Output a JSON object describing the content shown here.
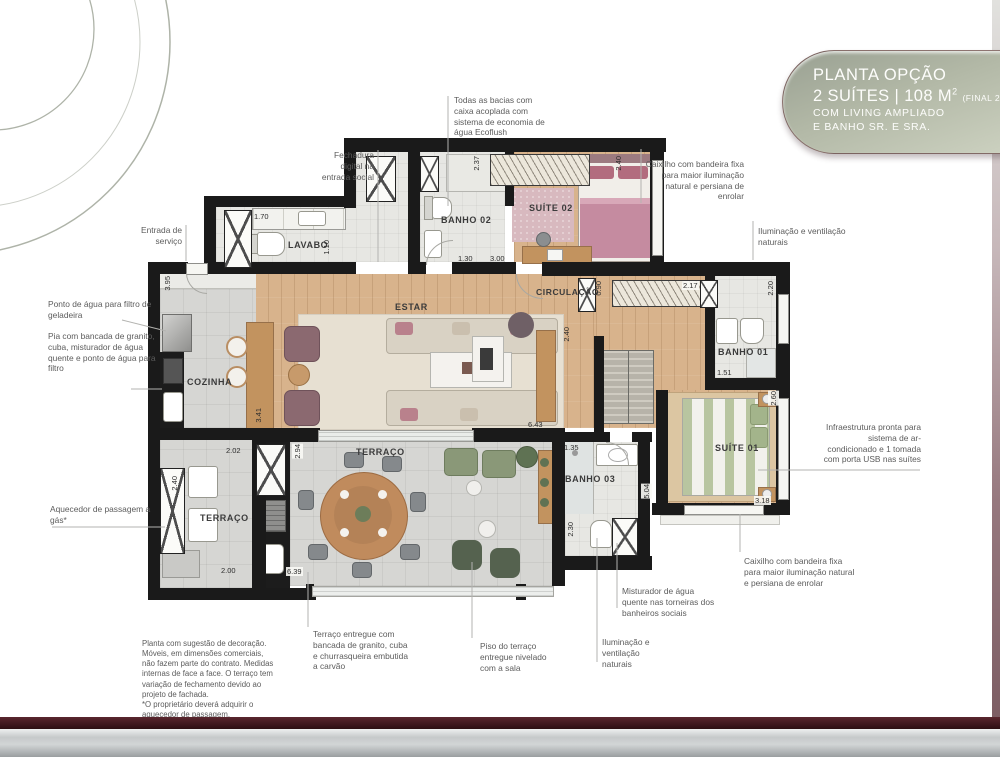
{
  "title_box": {
    "line1": "PLANTA OPÇÃO",
    "line2_main": "2 SUÍTES | 108 M",
    "line2_sup": "2",
    "line2_note": "(FINAL 2)",
    "line3": "COM LIVING AMPLIADO",
    "line4": "E BANHO SR. E SRA."
  },
  "rooms": {
    "lavabo": "LAVABO",
    "banho02": "BANHO 02",
    "suite02": "SUÍTE 02",
    "estar": "ESTAR",
    "circulacao": "CIRCULAÇÃO",
    "banho01": "BANHO 01",
    "suite01": "SUÍTE 01",
    "cozinha": "COZINHA",
    "terraco_servico": "TERRAÇO",
    "terraco": "TERRAÇO",
    "banho03": "BANHO 03"
  },
  "dims": {
    "closet_w": "1.70",
    "lavabo_h": "1.10",
    "servico_h": "3.95",
    "banho02_h": "2.37",
    "banho02_w": "1.30",
    "suite02_w": "3.00",
    "suite02_h": "2.40",
    "circ_w": "0.90",
    "wardrobe_w": "2.17",
    "banho01_h": "2.20",
    "banho01_w": "1.51",
    "circ_h": "2.40",
    "estar_w": "6.43",
    "estar_h": "3.41",
    "terraco_serv_gap": "2.02",
    "terraco_h": "2.94",
    "aquecedor_h": "2.40",
    "terraco_serv_w": "2.00",
    "terraco_w": "6.39",
    "banho03_w": "1.35",
    "banho03_h": "2.30",
    "terraco_right_h": "5.04",
    "suite01_h": "2.60",
    "suite01_w": "3.18"
  },
  "callouts": {
    "bacias": "Todas as bacias com caixa acoplada com sistema de economia de água Ecoflush",
    "fechadura": "Fechadura digital na entrada social",
    "entrada_servico": "Entrada de serviço",
    "ponto_agua": "Ponto de água para filtro de geladeira",
    "pia": "Pia com bancada de granito, cuba, misturador de água quente e ponto de água para filtro",
    "aquecedor": "Aquecedor de passagem a gás*",
    "caixilho_top": "Caixilho com bandeira fixa para maior iluminação natural e persiana de enrolar",
    "iluminacao_right": "Iluminação e ventilação naturais",
    "infraestrutura": "Infraestrutura pronta para sistema de ar-condicionado e 1 tomada com porta USB nas suítes",
    "caixilho_bottom": "Caixilho com bandeira fixa para maior iluminação natural e persiana de enrolar",
    "misturador": "Misturador de água quente nas torneiras dos banheiros sociais",
    "iluminacao_bottom": "Iluminação e ventilação naturais",
    "terraco_entregue": "Terraço entregue com bancada de granito, cuba e churrasqueira embutida a carvão",
    "piso_terraco": "Piso do terraço entregue nivelado com a sala"
  },
  "disclaimer": "Planta com sugestão de decoração. Móveis, em dimensões comerciais, não fazem parte do contrato. Medidas internas de face a face. O terraço tem variação de fechamento devido ao projeto de fachada.\n*O proprietário deverá adquirir o aquecedor de passagem.",
  "colors": {
    "wall": "#1a1a1a",
    "wood": "#d8b38c",
    "tile": "#d6d6d3",
    "title_green_dark": "#99a092",
    "title_green_light": "#cdd2c1",
    "accent_maroon": "#3a151b",
    "bed_suite01": "#b8c5a0",
    "bed_suite02": "#c58ba0"
  }
}
